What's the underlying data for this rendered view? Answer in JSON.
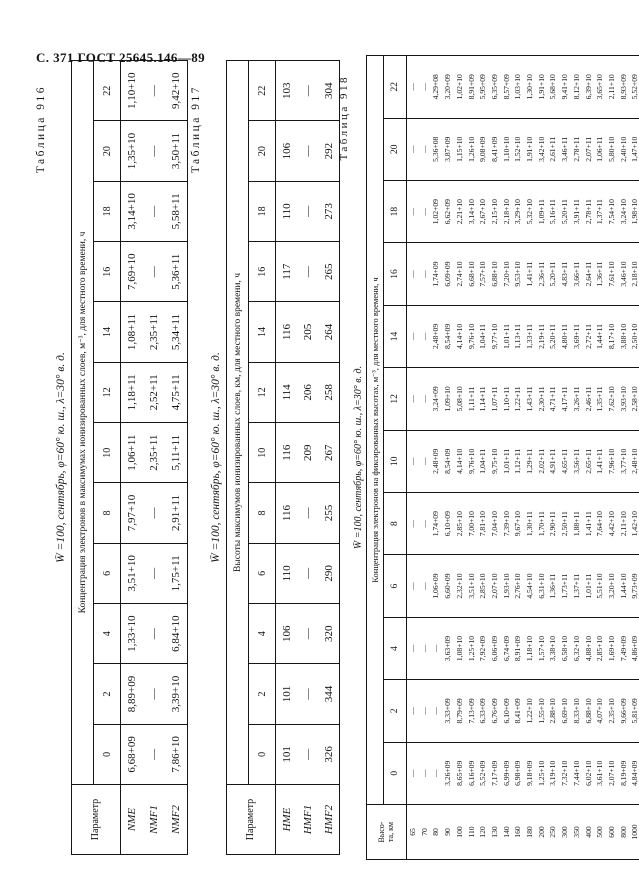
{
  "page_header": "С. 371 ГОСТ 25645.146—89",
  "tables": [
    {
      "caption": "Таблица 916",
      "title": "W̄ =100, сентябрь, φ=60° ю. ш., λ=30° в. д.",
      "stub_header": "Параметр",
      "span_header": "Концентрация электронов в максимумах ионизированных слоев, м⁻³, для местного времени, ч",
      "time_cols": [
        "0",
        "2",
        "4",
        "6",
        "8",
        "10",
        "12",
        "14",
        "16",
        "18",
        "20",
        "22"
      ],
      "rows": [
        {
          "label": "NME",
          "values": [
            "6,68+09",
            "8,89+09",
            "1,33+10",
            "3,51+10",
            "7,97+10",
            "1,06+11",
            "1,18+11",
            "1,08+11",
            "7,69+10",
            "3,14+10",
            "1,35+10",
            "1,10+10"
          ]
        },
        {
          "label": "NMF1",
          "values": [
            "—",
            "—",
            "—",
            "—",
            "—",
            "2,35+11",
            "2,52+11",
            "2,35+11",
            "—",
            "—",
            "—",
            "—"
          ]
        },
        {
          "label": "NMF2",
          "values": [
            "7,86+10",
            "3,39+10",
            "6,84+10",
            "1,75+11",
            "2,91+11",
            "5,11+11",
            "4,75+11",
            "5,34+11",
            "5,36+11",
            "5,58+11",
            "3,50+11",
            "9,42+10"
          ]
        }
      ]
    },
    {
      "caption": "Таблица 917",
      "title": "W̄ =100, сентябрь, φ=60° ю. ш., λ=30° в. д.",
      "stub_header": "Параметр",
      "span_header": "Высоты максимумов ионизированных слоев, км, для местного времени, ч",
      "time_cols": [
        "0",
        "2",
        "4",
        "6",
        "8",
        "10",
        "12",
        "14",
        "16",
        "18",
        "20",
        "22"
      ],
      "rows": [
        {
          "label": "HME",
          "values": [
            "101",
            "101",
            "106",
            "110",
            "116",
            "116",
            "114",
            "116",
            "117",
            "110",
            "106",
            "103"
          ]
        },
        {
          "label": "HMF1",
          "values": [
            "—",
            "—",
            "—",
            "—",
            "—",
            "209",
            "206",
            "205",
            "—",
            "—",
            "—",
            "—"
          ]
        },
        {
          "label": "HMF2",
          "values": [
            "326",
            "344",
            "320",
            "290",
            "255",
            "267",
            "258",
            "264",
            "265",
            "273",
            "292",
            "304"
          ]
        }
      ]
    },
    {
      "caption": "Таблица 918",
      "title": "W̄ =100, сентябрь, φ=60° ю. ш., λ=30° в. д.",
      "stub_header": "Высо-\nта, км",
      "span_header": "Концентрация электронов на фиксированных высотах, м⁻³, для местного времени, ч",
      "time_cols": [
        "0",
        "2",
        "4",
        "6",
        "8",
        "10",
        "12",
        "14",
        "16",
        "18",
        "20",
        "22"
      ],
      "heights": [
        "65",
        "70",
        "80",
        "90",
        "100",
        "110",
        "120",
        "130",
        "140",
        "160",
        "180",
        "200",
        "250",
        "300",
        "350",
        "400",
        "500",
        "600",
        "800",
        "1000"
      ],
      "cols": {
        "0": [
          "—",
          "—",
          "—",
          "3,26+09",
          "8,65+09",
          "6,16+09",
          "5,52+09",
          "7,17+09",
          "6,99+09",
          "6,98+09",
          "9,18+09",
          "1,25+10",
          "3,19+10",
          "7,32+10",
          "7,44+10",
          "6,02+10",
          "3,61+10",
          "2,07+10",
          "8,19+09",
          "4,84+09"
        ],
        "2": [
          "—",
          "—",
          "—",
          "3,33+09",
          "8,79+09",
          "7,13+09",
          "6,33+09",
          "6,76+09",
          "6,10+09",
          "8,41+09",
          "1,22+10",
          "1,55+10",
          "2,88+10",
          "6,69+10",
          "8,33+10",
          "6,88+10",
          "4,07+10",
          "2,35+10",
          "9,66+09",
          "5,81+09"
        ],
        "4": [
          "—",
          "—",
          "—",
          "3,63+09",
          "1,08+10",
          "1,25+10",
          "7,92+09",
          "6,06+09",
          "6,74+09",
          "8,91+09",
          "1,18+10",
          "1,57+10",
          "3,38+10",
          "6,58+10",
          "6,32+10",
          "4,88+10",
          "2,85+10",
          "1,69+10",
          "7,49+09",
          "4,86+09"
        ],
        "6": [
          "—",
          "—",
          "1,06+09",
          "6,60+09",
          "2,32+10",
          "3,51+10",
          "2,85+10",
          "2,07+10",
          "1,93+10",
          "2,76+10",
          "4,54+10",
          "6,31+10",
          "1,36+11",
          "1,73+11",
          "1,37+11",
          "1,01+11",
          "5,51+10",
          "3,20+10",
          "1,44+10",
          "9,73+09"
        ],
        "8": [
          "—",
          "—",
          "1,74+09",
          "6,10+09",
          "2,85+10",
          "7,00+10",
          "7,81+10",
          "7,04+10",
          "7,39+10",
          "9,67+10",
          "1,30+11",
          "1,70+11",
          "2,90+11",
          "2,50+11",
          "1,88+11",
          "1,41+11",
          "7,64+10",
          "4,42+10",
          "2,11+10",
          "1,42+10"
        ],
        "10": [
          "—",
          "—",
          "2,48+09",
          "8,54+09",
          "4,14+10",
          "9,76+10",
          "1,04+11",
          "9,75+10",
          "1,01+11",
          "1,12+11",
          "1,29+11",
          "2,02+11",
          "4,91+11",
          "4,65+11",
          "3,56+11",
          "2,65+11",
          "1,41+11",
          "7,96+10",
          "3,77+10",
          "2,48+10"
        ],
        "12": [
          "—",
          "—",
          "3,24+09",
          "1,09+10",
          "5,08+10",
          "1,11+11",
          "1,14+11",
          "1,07+11",
          "1,10+11",
          "1,22+11",
          "1,43+11",
          "2,30+11",
          "4,71+11",
          "4,17+11",
          "3,26+11",
          "2,46+11",
          "1,35+11",
          "7,62+10",
          "3,93+10",
          "2,58+10"
        ],
        "14": [
          "—",
          "—",
          "2,48+09",
          "8,54+09",
          "4,14+10",
          "9,76+10",
          "1,04+11",
          "9,77+10",
          "1,01+11",
          "1,13+11",
          "1,33+11",
          "2,19+11",
          "5,20+11",
          "4,80+11",
          "3,69+11",
          "2,72+11",
          "1,44+11",
          "8,17+10",
          "3,88+10",
          "2,50+10"
        ],
        "16": [
          "—",
          "—",
          "1,74+09",
          "6,09+09",
          "2,74+10",
          "6,68+10",
          "7,57+10",
          "6,88+10",
          "7,20+10",
          "9,53+10",
          "1,41+11",
          "2,36+11",
          "5,20+11",
          "4,83+11",
          "3,66+11",
          "2,64+11",
          "1,36+11",
          "7,61+10",
          "3,46+10",
          "2,18+10"
        ],
        "18": [
          "—",
          "—",
          "1,02+09",
          "6,62+09",
          "2,21+10",
          "3,14+10",
          "2,67+10",
          "2,15+10",
          "2,18+10",
          "3,29+10",
          "5,32+10",
          "1,09+11",
          "5,16+11",
          "5,20+11",
          "3,91+11",
          "2,78+11",
          "1,37+11",
          "7,54+10",
          "3,24+10",
          "1,98+10"
        ],
        "20": [
          "—",
          "—",
          "5,36+08",
          "3,87+09",
          "1,15+10",
          "1,26+10",
          "9,08+09",
          "8,41+09",
          "1,10+10",
          "1,52+10",
          "1,91+10",
          "3,42+10",
          "2,61+11",
          "3,46+11",
          "2,78+11",
          "2,07+11",
          "1,06+11",
          "5,80+10",
          "2,40+10",
          "1,47+10"
        ],
        "22": [
          "—",
          "—",
          "4,29+08",
          "3,20+09",
          "1,02+10",
          "8,91+09",
          "5,95+09",
          "6,35+09",
          "8,57+09",
          "1,03+10",
          "1,30+10",
          "1,91+10",
          "5,68+10",
          "9,41+10",
          "8,12+10",
          "6,39+10",
          "3,65+10",
          "2,11+10",
          "8,93+09",
          "5,52+09"
        ]
      }
    }
  ]
}
